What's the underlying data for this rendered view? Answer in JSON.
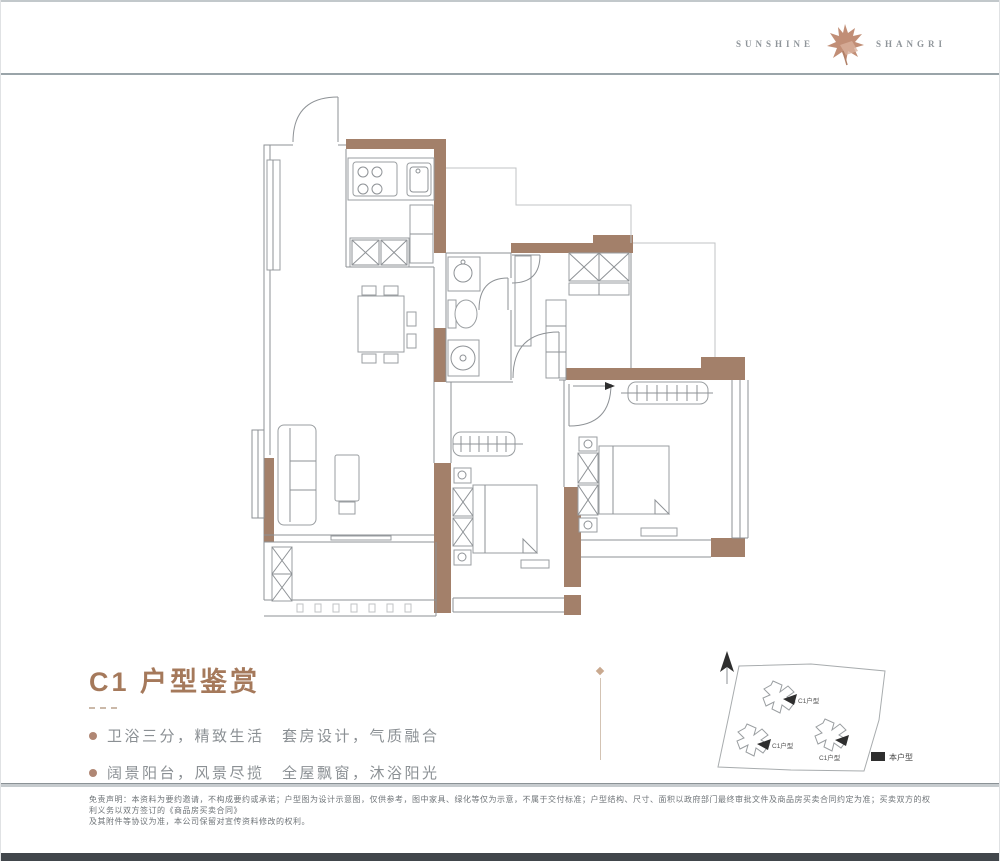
{
  "header": {
    "brand_left": "SUNSHINE",
    "brand_right": "SHANGRI"
  },
  "title_block": {
    "title": "C1 户型鉴赏",
    "bullets": [
      "卫浴三分，精致生活　套房设计，气质融合",
      "阔景阳台，风景尽揽　全屋飘窗，沐浴阳光"
    ]
  },
  "sitemap": {
    "building_labels": [
      "C1户型",
      "C1户型",
      "C1户型"
    ],
    "legend_label": "本户型"
  },
  "footer": {
    "disclaimer_line1": "免责声明：本资料为要约邀请，不构成要约或承诺；户型图为设计示意图，仅供参考，图中家具、绿化等仅为示意，不属于交付标准；户型结构、尺寸、面积以政府部门最终审批文件及商品房买卖合同约定为准；买卖双方的权利义务以双方签订的《商品房买卖合同》",
    "disclaimer_line2": "及其附件等协议为准，本公司保留对宣传资料修改的权利。"
  },
  "colors": {
    "wall": "#a3806a",
    "accent": "#a5795b",
    "logo": "#c18e76",
    "line": "#8e9296"
  }
}
